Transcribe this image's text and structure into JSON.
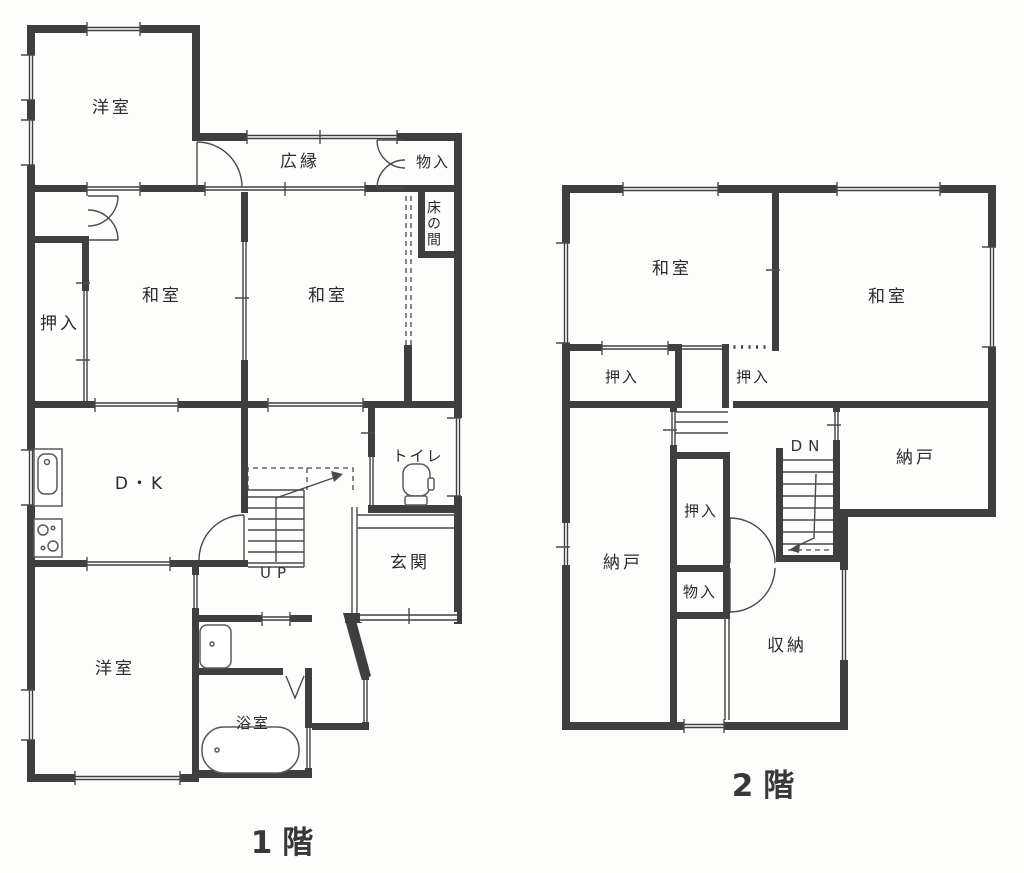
{
  "drawing": {
    "kind": "floor-plan",
    "colors": {
      "wall": "#3f3f3f",
      "line": "#4a4a4a",
      "text": "#2a2a2a",
      "background": "#ffffff"
    }
  },
  "floor1": {
    "title": "1階",
    "rooms": {
      "yoshitsu_nw": "洋室",
      "hiroen": "広縁",
      "monoire": "物入",
      "tokonoma": "床の間",
      "oshiire": "押入",
      "washitsu_w": "和室",
      "washitsu_e": "和室",
      "dk": "D・K",
      "toilet": "トイレ",
      "genkan": "玄関",
      "yoshitsu_sw": "洋室",
      "bathroom": "浴室"
    },
    "stairs": {
      "up_label": "UP"
    }
  },
  "floor2": {
    "title": "2階",
    "rooms": {
      "washitsu_w": "和室",
      "washitsu_e": "和室",
      "oshiire_w": "押入",
      "oshiire_e": "押入",
      "oshiire_c": "押入",
      "nando_e": "納戸",
      "nando_w": "納戸",
      "monoire": "物入",
      "shuno": "収納"
    },
    "stairs": {
      "down_label": "DN"
    }
  }
}
